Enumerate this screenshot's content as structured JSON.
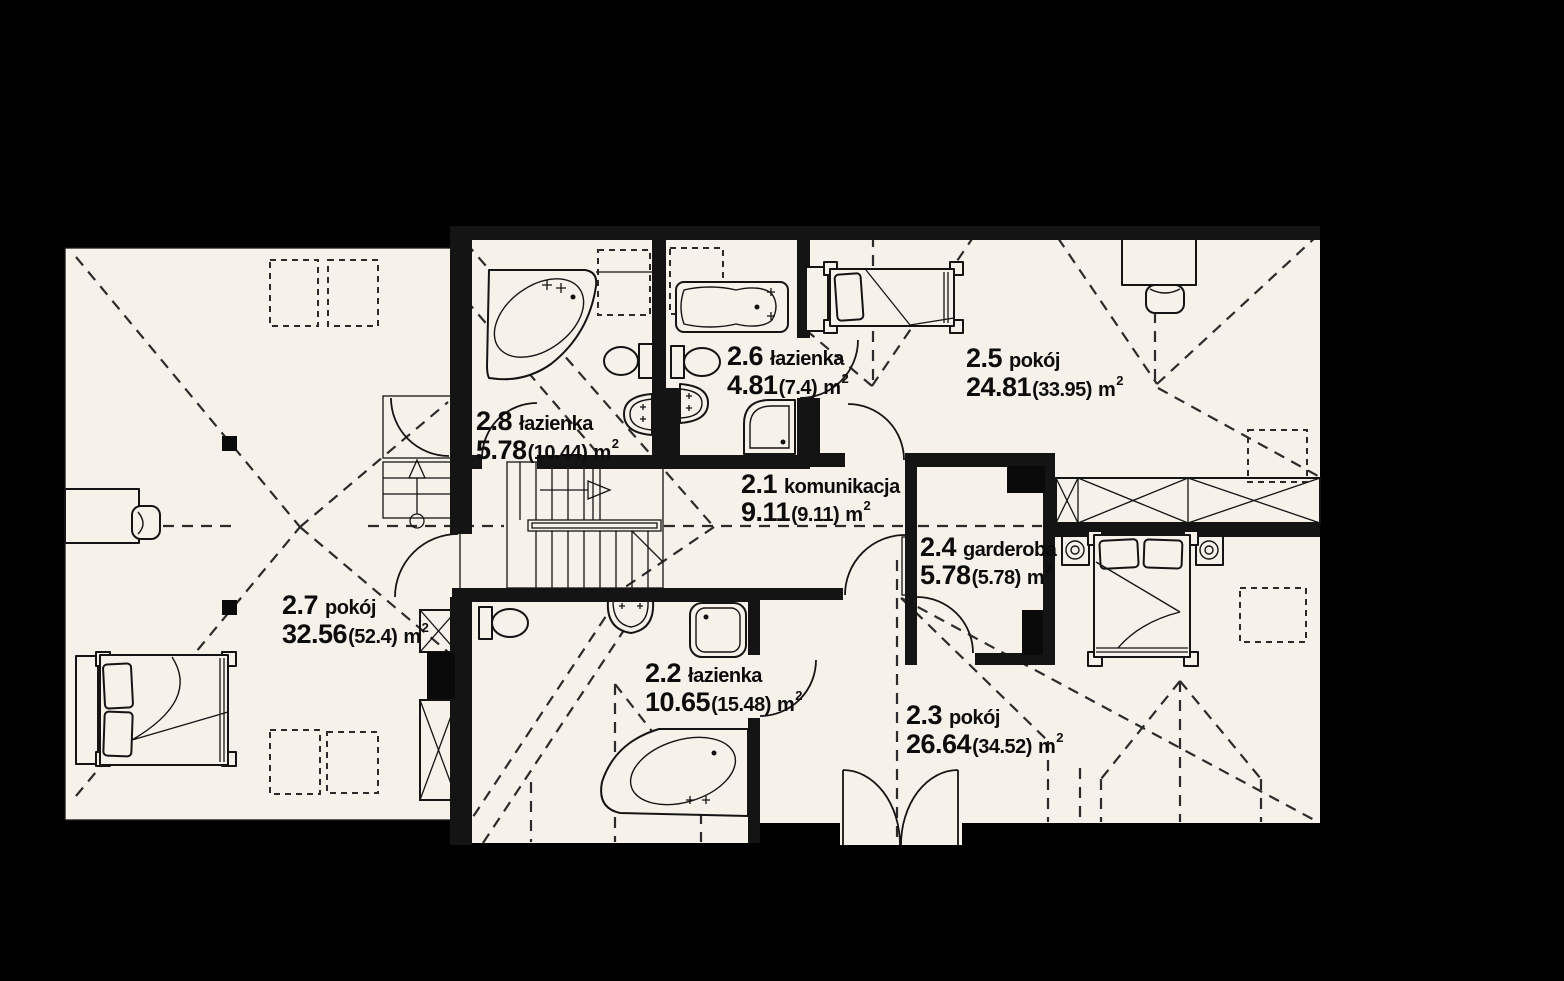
{
  "plan": {
    "colors": {
      "background": "#000000",
      "floor": "#f6f1e9",
      "line": "#141414",
      "dash": "#2b2b2b",
      "text": "#0c0c0c"
    },
    "rooms": [
      {
        "num": "2.8",
        "name": "łazienka",
        "area": "5.78",
        "total": "(10.44)",
        "unit": "m",
        "sup": "2"
      },
      {
        "num": "2.6",
        "name": "łazienka",
        "area": "4.81",
        "total": "(7.4)",
        "unit": "m",
        "sup": "2"
      },
      {
        "num": "2.5",
        "name": "pokój",
        "area": "24.81",
        "total": "(33.95)",
        "unit": "m",
        "sup": "2"
      },
      {
        "num": "2.1",
        "name": "komunikacja",
        "area": "9.11",
        "total": "(9.11)",
        "unit": "m",
        "sup": "2"
      },
      {
        "num": "2.4",
        "name": "garderoba",
        "area": "5.78",
        "total": "(5.78)",
        "unit": "m",
        "sup": "2"
      },
      {
        "num": "2.7",
        "name": "pokój",
        "area": "32.56",
        "total": "(52.4)",
        "unit": "m",
        "sup": "2"
      },
      {
        "num": "2.2",
        "name": "łazienka",
        "area": "10.65",
        "total": "(15.48)",
        "unit": "m",
        "sup": "2"
      },
      {
        "num": "2.3",
        "name": "pokój",
        "area": "26.64",
        "total": "(34.52)",
        "unit": "m",
        "sup": "2"
      }
    ]
  }
}
